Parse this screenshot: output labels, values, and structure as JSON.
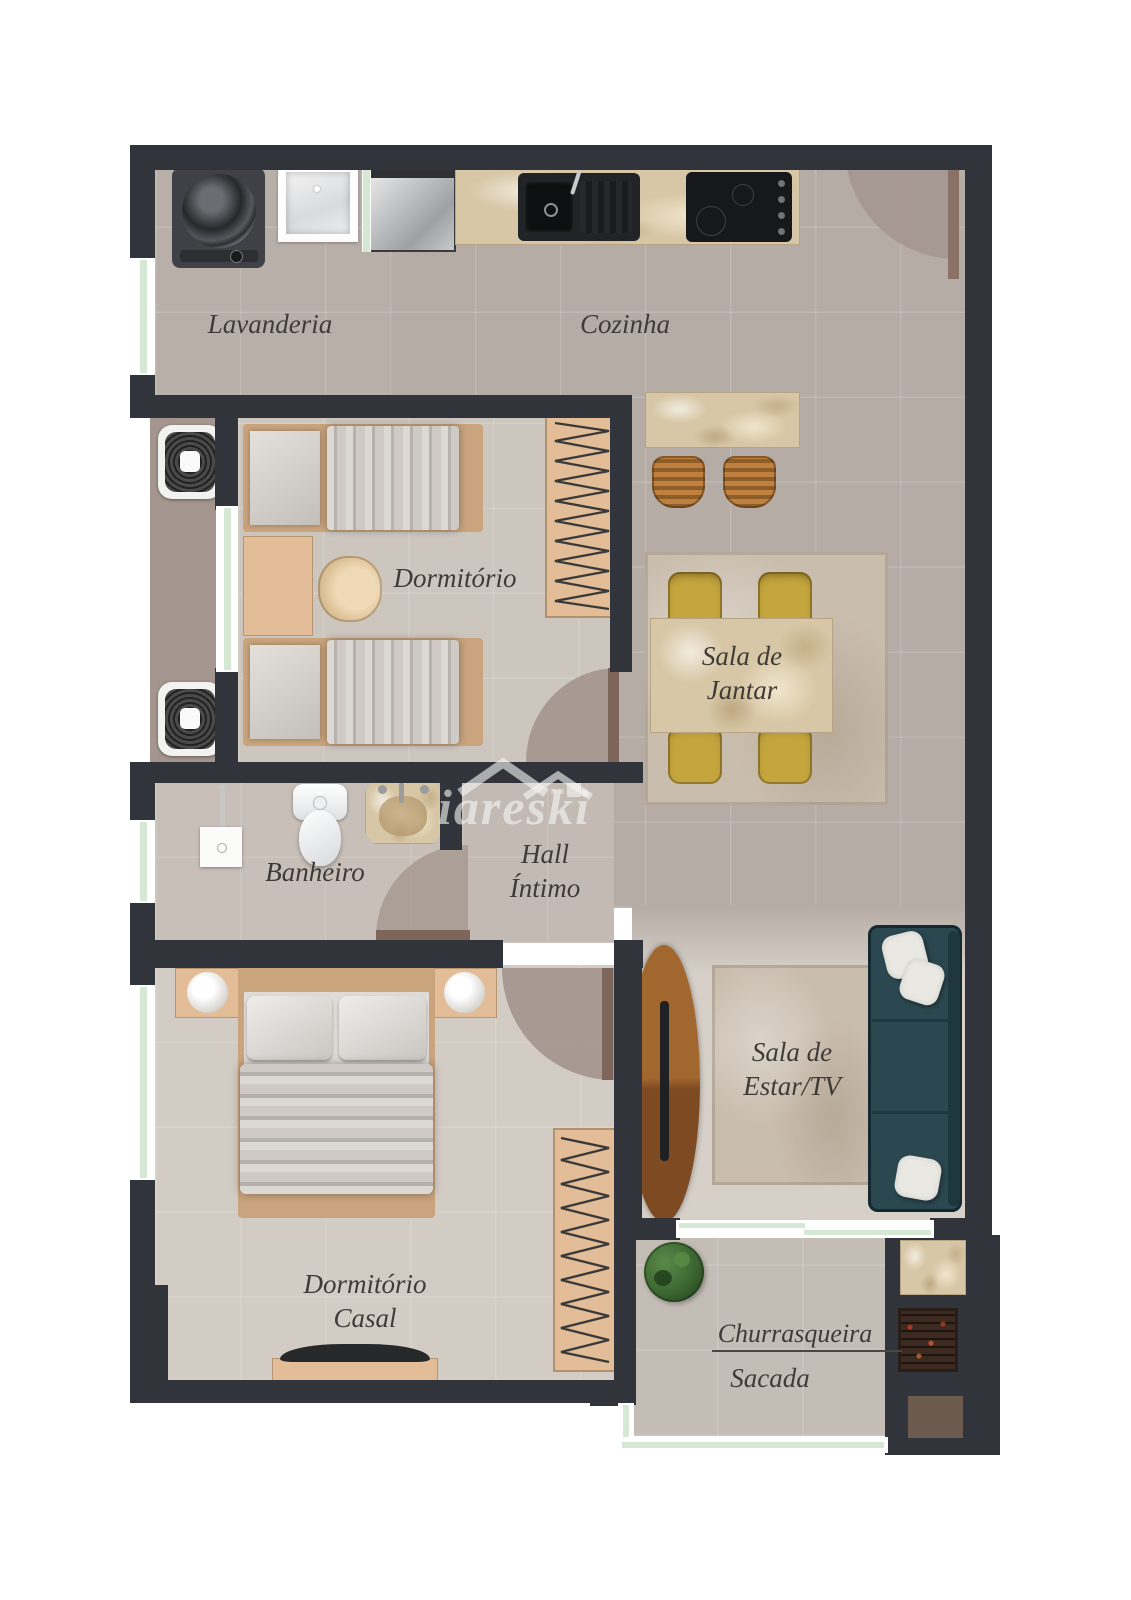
{
  "watermark": {
    "brand": "iareski",
    "logo": "roof-logo-icon"
  },
  "labels": {
    "lavanderia": "Lavanderia",
    "cozinha": "Cozinha",
    "dormitorio": "Dormitório",
    "sala_jantar_1": "Sala de",
    "sala_jantar_2": "Jantar",
    "hall_1": "Hall",
    "hall_2": "Íntimo",
    "banheiro": "Banheiro",
    "dormitorio_casal_1": "Dormitório",
    "dormitorio_casal_2": "Casal",
    "sala_estar_1": "Sala de",
    "sala_estar_2": "Estar/TV",
    "churrasqueira": "Churrasqueira",
    "sacada": "Sacada"
  },
  "colors": {
    "wall": "#31343a",
    "floor_social": "#b5aca5",
    "floor_bedroom": "#cdc6bf",
    "floor_master": "#d3ccc4",
    "floor_living": "#d6d0c8",
    "floor_balcony": "#c4bdb6",
    "service_recess": "#a4968f",
    "door_swing": "#a59790",
    "door_leaf": "#7e655a",
    "window_glass": "#d5e8d3",
    "marble": "#d8c7a6",
    "wood_tan": "#e2bd97",
    "chair_yellow": "#c5a63e",
    "stool_bronze": "#b07434",
    "sofa_teal": "#2b4750",
    "tv_wood": "#9c6130",
    "plant_green": "#3c6631",
    "label_text": "#3f3b38"
  },
  "icons": {
    "washer": "washing-machine-icon",
    "laundry_sink": "laundry-sink-icon",
    "fridge": "refrigerator-icon",
    "kitchen_sink": "kitchen-sink-icon",
    "cooktop": "cooktop-icon",
    "stools": "bar-stool-icon",
    "dining": "dining-table-icon",
    "ac": "ac-condenser-icon",
    "shower": "shower-icon",
    "toilet": "toilet-icon",
    "vanity": "vanity-sink-icon",
    "bed": "bed-icon",
    "wardrobe": "wardrobe-icon",
    "sofa": "sofa-icon",
    "tv": "tv-icon",
    "plant": "plant-icon",
    "grill": "barbecue-grill-icon"
  }
}
